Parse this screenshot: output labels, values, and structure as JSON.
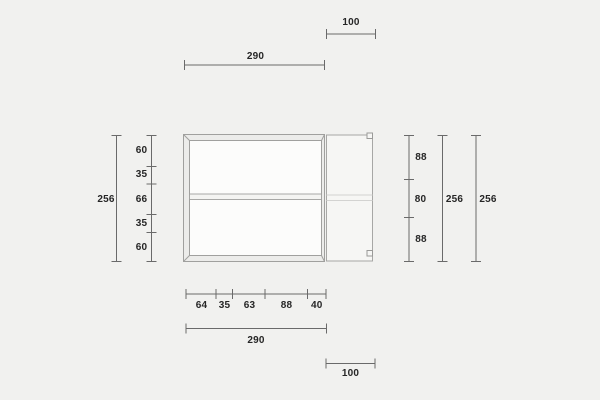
{
  "drawing": {
    "title": "cabinet-dimension-drawing",
    "top": {
      "body_width": "290",
      "door_width": "100"
    },
    "left": {
      "overall": "256",
      "segments": [
        "60",
        "35",
        "66",
        "35",
        "60"
      ]
    },
    "right": {
      "segments": [
        "88",
        "80",
        "88"
      ],
      "overall": "256",
      "overall_outer": "256"
    },
    "bottom": {
      "segments": [
        "64",
        "35",
        "63",
        "88",
        "40"
      ],
      "body_width": "290",
      "door_width": "100"
    }
  },
  "colors": {
    "background": "#f1f1ef",
    "dimension_line": "#6a6a6a",
    "label_text": "#262626",
    "cabinet_outline": "#a0a09e",
    "cabinet_frame_fill": "#ececea",
    "cabinet_interior_fill": "#fcfcfb",
    "door_fill": "#f6f6f4"
  }
}
